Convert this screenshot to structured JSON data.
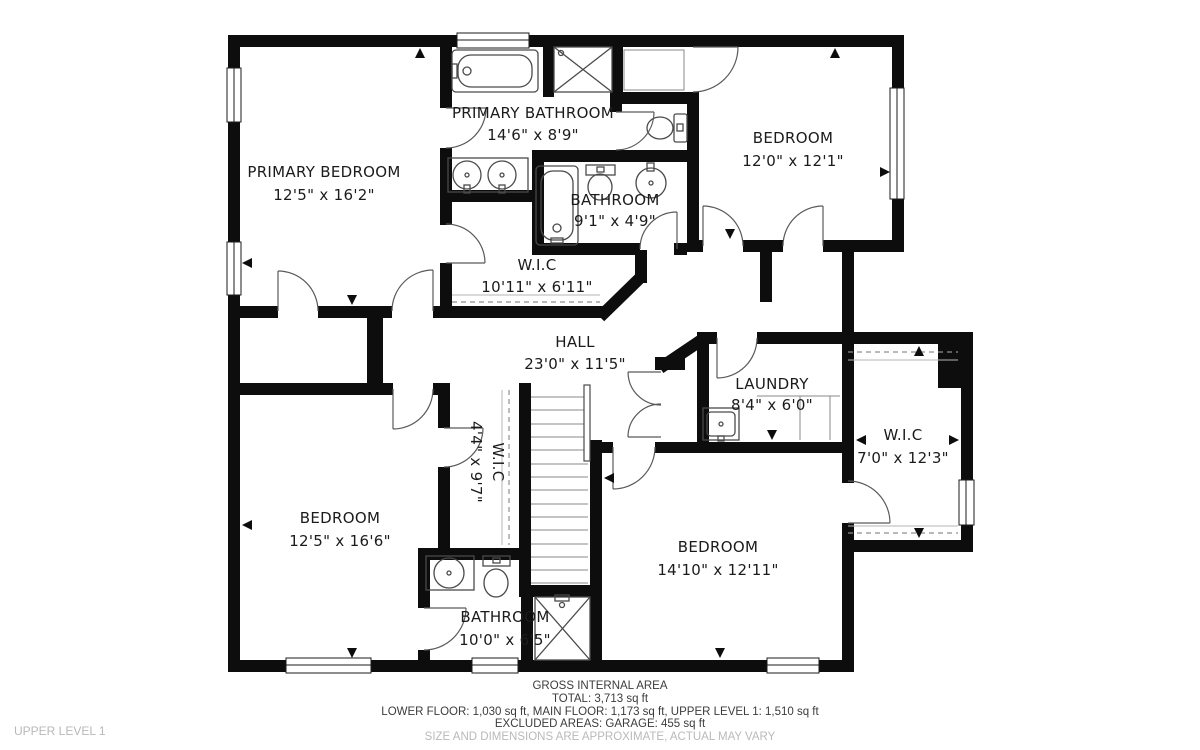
{
  "floor_label": "UPPER LEVEL 1",
  "rooms": [
    {
      "id": "primary-bedroom",
      "name": "PRIMARY BEDROOM",
      "dims": "12'5\" x 16'2\""
    },
    {
      "id": "primary-bathroom",
      "name": "PRIMARY BATHROOM",
      "dims": "14'6\" x 8'9\""
    },
    {
      "id": "bedroom-top-right",
      "name": "BEDROOM",
      "dims": "12'0\" x 12'1\""
    },
    {
      "id": "bathroom-middle",
      "name": "BATHROOM",
      "dims": "9'1\" x 4'9\""
    },
    {
      "id": "wic-primary",
      "name": "W.I.C",
      "dims": "10'11\" x 6'11\""
    },
    {
      "id": "hall",
      "name": "HALL",
      "dims": "23'0\" x 11'5\""
    },
    {
      "id": "laundry",
      "name": "LAUNDRY",
      "dims": "8'4\" x 6'0\""
    },
    {
      "id": "wic-right",
      "name": "W.I.C",
      "dims": "7'0\" x 12'3\""
    },
    {
      "id": "bedroom-bottom-left",
      "name": "BEDROOM",
      "dims": "12'5\" x 16'6\""
    },
    {
      "id": "wic-small",
      "name": "W.I.C",
      "dims": "4'4\" x 9'7\""
    },
    {
      "id": "bedroom-bottom-right",
      "name": "BEDROOM",
      "dims": "14'10\" x 12'11\""
    },
    {
      "id": "bathroom-bottom",
      "name": "BATHROOM",
      "dims": "10'0\" x 6'5\""
    }
  ],
  "footer": {
    "heading": "GROSS INTERNAL AREA",
    "total": "TOTAL: 3,713 sq ft",
    "floors": "LOWER FLOOR: 1,030 sq ft, MAIN FLOOR: 1,173 sq ft, UPPER LEVEL 1: 1,510 sq ft",
    "excluded": "EXCLUDED AREAS: GARAGE: 455 sq ft",
    "disclaimer": "SIZE AND DIMENSIONS ARE APPROXIMATE, ACTUAL MAY VARY"
  },
  "colors": {
    "wall": "#0d0d0d",
    "label": "#1b1b1b",
    "muted": "#b9b9b9"
  }
}
